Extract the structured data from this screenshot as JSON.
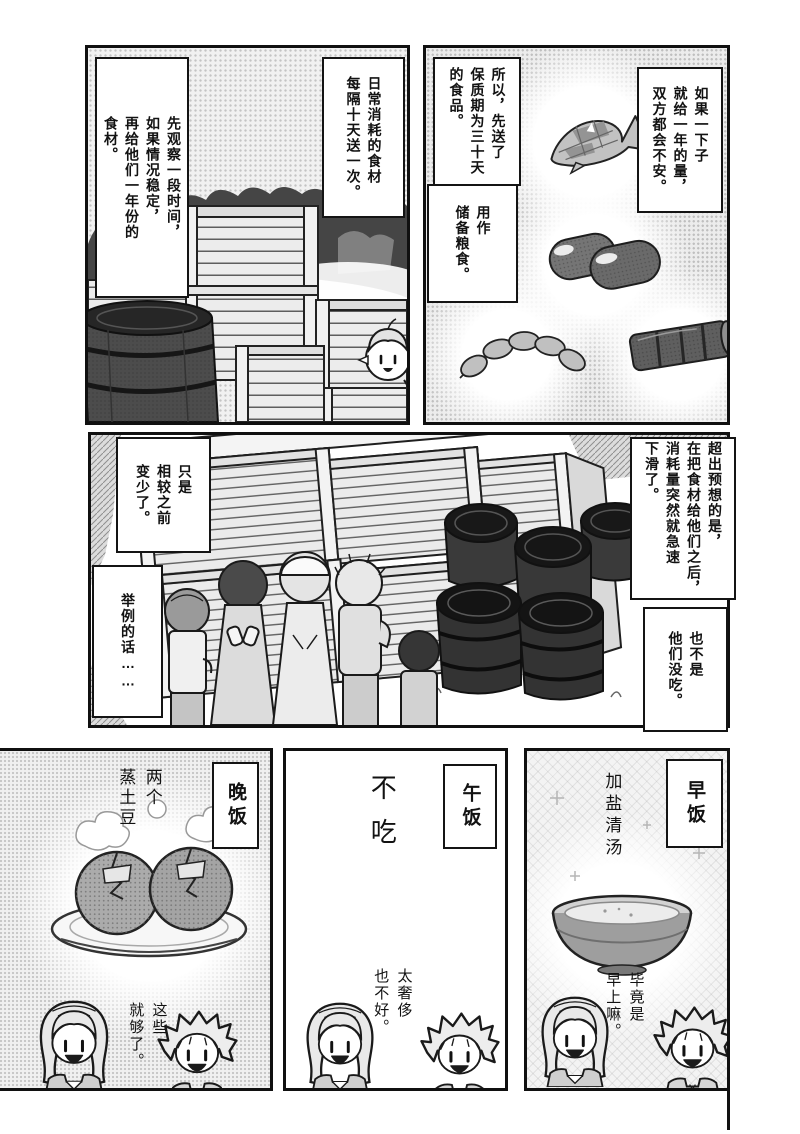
{
  "page": {
    "kind": "manga-page",
    "language": "zh"
  },
  "colors": {
    "ink": "#111111",
    "paper": "#ffffff",
    "halftone": "#ececec",
    "tree_tone": "#454545",
    "barrel_tone": "#333333"
  },
  "panels": {
    "top_left": {
      "bubbles": {
        "schedule": "日常消耗的食材\n每隔十天送一次。",
        "observe": "先观察一段时间，\n如果情况稳定，\n再给他们一年份的\n食材。"
      }
    },
    "top_right": {
      "bubbles": {
        "worry": "如果一下子\n就给一年的量，\n双方都会不安。",
        "shelf_life": "所以，先送了\n保质期为三十天\n的食品。",
        "reserve": "用作\n储备粮食。"
      }
    },
    "middle": {
      "bubbles": {
        "unexpected": "超出预想的是，\n在把食材给他们之后，\n消耗量突然就急速\n下滑了。",
        "not_skipping": "也不是\n他们没吃。",
        "just_less": "只是\n相较之前\n变少了。",
        "for_example": "举例的话……"
      }
    },
    "bottom_left": {
      "label": "晚饭",
      "caption": "两个\n蒸土豆",
      "speech": "这些\n就够了。"
    },
    "bottom_middle": {
      "label": "午饭",
      "caption": "不吃",
      "speech": "太奢侈\n也不好。"
    },
    "bottom_right": {
      "label": "早饭",
      "caption": "加盐清汤",
      "speech": "毕竟是\n早上嘛。"
    }
  }
}
